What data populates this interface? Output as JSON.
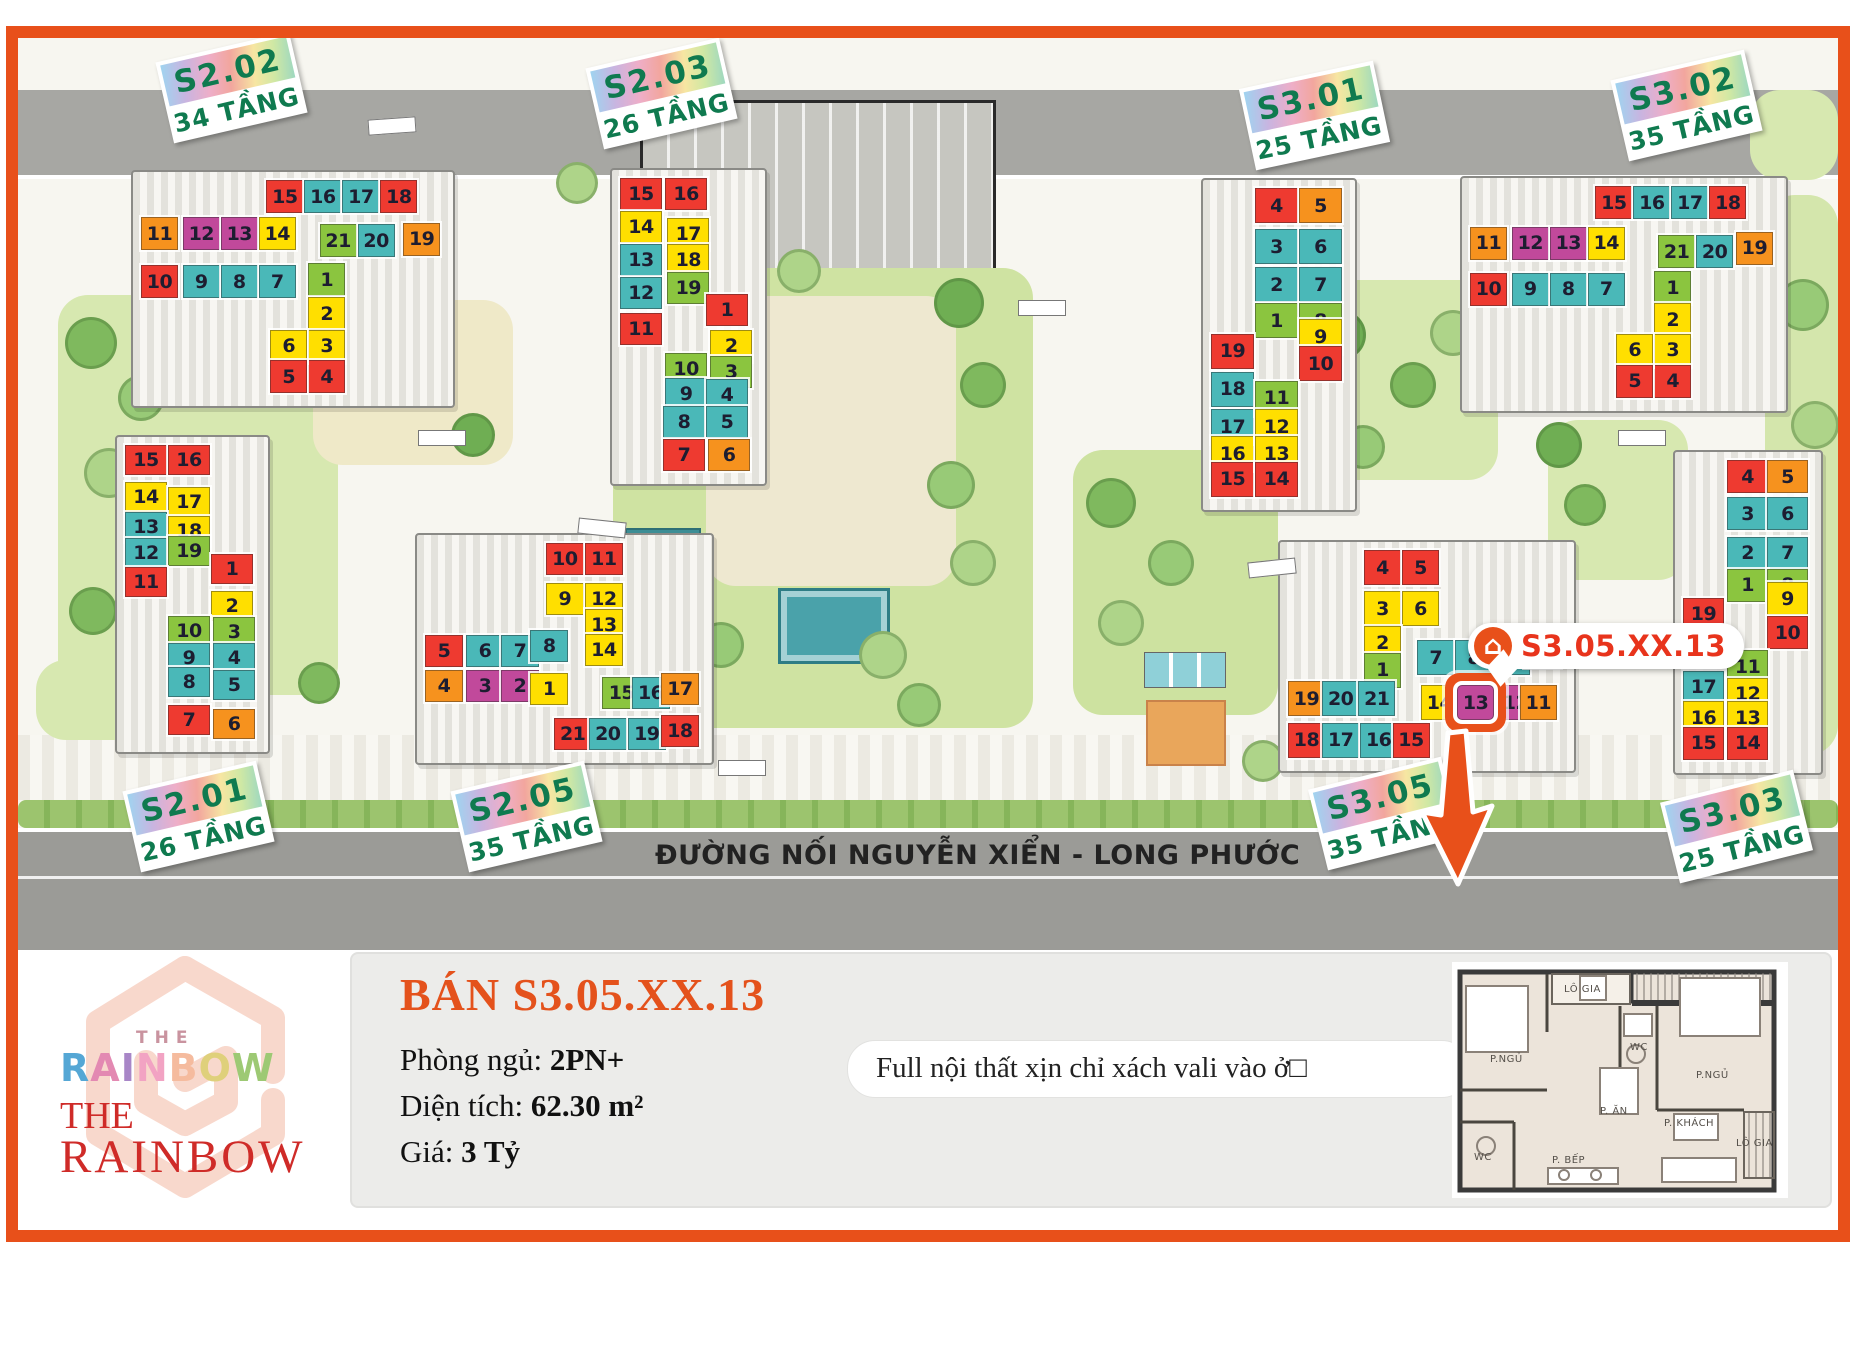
{
  "map": {
    "road_label": "ĐƯỜNG NỐI NGUYỄN XIỂN - LONG PHƯỚC",
    "callout": {
      "label": "S3.05.XX.13",
      "icon": "home"
    },
    "palette": {
      "R": "#ee3a30",
      "T": "#4ab8b8",
      "Y": "#ffdf00",
      "O": "#f6921e",
      "P": "#c1499b",
      "G": "#8bc53f"
    },
    "buildings": [
      {
        "name": "S2.02",
        "floors": "34 TẦNG",
        "badge": [
          145,
          8,
          -13
        ],
        "origin": [
          123,
          142
        ],
        "cell": [
          38,
          34
        ],
        "units": [
          [
            15,
            "R",
            3.3,
            0
          ],
          [
            16,
            "T",
            4.3,
            0
          ],
          [
            17,
            "T",
            5.3,
            0
          ],
          [
            18,
            "R",
            6.3,
            0
          ],
          [
            11,
            "O",
            0,
            1.1
          ],
          [
            12,
            "P",
            1.1,
            1.1
          ],
          [
            13,
            "P",
            2.1,
            1.1
          ],
          [
            14,
            "Y",
            3.1,
            1.1
          ],
          [
            21,
            "G",
            4.7,
            1.3
          ],
          [
            20,
            "T",
            5.7,
            1.3
          ],
          [
            19,
            "O",
            6.9,
            1.25
          ],
          [
            10,
            "R",
            0,
            2.5
          ],
          [
            9,
            "T",
            1.1,
            2.5
          ],
          [
            8,
            "T",
            2.1,
            2.5
          ],
          [
            7,
            "T",
            3.1,
            2.5
          ],
          [
            1,
            "G",
            4.4,
            2.45
          ],
          [
            2,
            "Y",
            4.4,
            3.45
          ],
          [
            3,
            "Y",
            4.4,
            4.4
          ],
          [
            4,
            "R",
            4.4,
            5.3
          ],
          [
            6,
            "Y",
            3.4,
            4.4
          ],
          [
            5,
            "R",
            3.4,
            5.3
          ]
        ]
      },
      {
        "name": "S2.03",
        "floors": "26 TẦNG",
        "badge": [
          575,
          14,
          -13
        ],
        "origin": [
          602,
          140
        ],
        "cell": [
          43,
          33
        ],
        "units": [
          [
            15,
            "R",
            0,
            0
          ],
          [
            16,
            "R",
            1.05,
            0
          ],
          [
            14,
            "Y",
            0,
            1
          ],
          [
            17,
            "Y",
            1.1,
            1.2
          ],
          [
            13,
            "T",
            0,
            2
          ],
          [
            18,
            "Y",
            1.1,
            2.0
          ],
          [
            12,
            "T",
            0,
            3
          ],
          [
            19,
            "G",
            1.1,
            2.85
          ],
          [
            11,
            "R",
            0,
            4.1
          ],
          [
            1,
            "R",
            2.0,
            3.5
          ],
          [
            2,
            "Y",
            2.1,
            4.6
          ],
          [
            10,
            "G",
            1.05,
            5.3
          ],
          [
            3,
            "G",
            2.1,
            5.4
          ],
          [
            9,
            "T",
            1.05,
            6.05
          ],
          [
            4,
            "T",
            2.0,
            6.1
          ],
          [
            8,
            "T",
            1.0,
            6.9
          ],
          [
            5,
            "T",
            2.0,
            6.9
          ],
          [
            7,
            "R",
            1.0,
            7.9
          ],
          [
            6,
            "O",
            2.05,
            7.9
          ]
        ]
      },
      {
        "name": "S3.01",
        "floors": "25 TẦNG",
        "badge": [
          1228,
          36,
          -12
        ],
        "origin": [
          1193,
          150
        ],
        "cell": [
          44,
          36
        ],
        "units": [
          [
            4,
            "R",
            1,
            0
          ],
          [
            5,
            "O",
            2,
            0
          ],
          [
            3,
            "T",
            1,
            1.15
          ],
          [
            6,
            "T",
            2,
            1.15
          ],
          [
            2,
            "T",
            1,
            2.2
          ],
          [
            7,
            "T",
            2,
            2.2
          ],
          [
            1,
            "G",
            1,
            3.2
          ],
          [
            8,
            "G",
            2,
            3.2
          ],
          [
            9,
            "Y",
            2,
            3.65
          ],
          [
            10,
            "R",
            2,
            4.4
          ],
          [
            19,
            "R",
            0,
            4.05
          ],
          [
            18,
            "T",
            0,
            5.1
          ],
          [
            17,
            "T",
            0,
            6.15
          ],
          [
            16,
            "Y",
            0,
            6.9
          ],
          [
            15,
            "R",
            0,
            7.6
          ],
          [
            11,
            "G",
            1,
            5.35
          ],
          [
            12,
            "Y",
            1,
            6.15
          ],
          [
            13,
            "Y",
            1,
            6.9
          ],
          [
            14,
            "R",
            1,
            7.6
          ]
        ]
      },
      {
        "name": "S3.02",
        "floors": "35 TẦNG",
        "badge": [
          1600,
          26,
          -13
        ],
        "origin": [
          1452,
          148
        ],
        "cell": [
          38,
          34
        ],
        "units": [
          [
            15,
            "R",
            3.3,
            0
          ],
          [
            16,
            "T",
            4.3,
            0
          ],
          [
            17,
            "T",
            5.3,
            0
          ],
          [
            18,
            "R",
            6.3,
            0
          ],
          [
            11,
            "O",
            0,
            1.2
          ],
          [
            12,
            "P",
            1.1,
            1.2
          ],
          [
            13,
            "P",
            2.1,
            1.2
          ],
          [
            14,
            "Y",
            3.1,
            1.2
          ],
          [
            21,
            "G",
            4.95,
            1.45
          ],
          [
            20,
            "T",
            5.95,
            1.45
          ],
          [
            19,
            "O",
            7.0,
            1.35
          ],
          [
            10,
            "R",
            0,
            2.55
          ],
          [
            9,
            "T",
            1.1,
            2.55
          ],
          [
            8,
            "T",
            2.1,
            2.55
          ],
          [
            7,
            "T",
            3.1,
            2.55
          ],
          [
            1,
            "G",
            4.85,
            2.5
          ],
          [
            2,
            "Y",
            4.85,
            3.45
          ],
          [
            3,
            "Y",
            4.85,
            4.35
          ],
          [
            4,
            "R",
            4.85,
            5.25
          ],
          [
            6,
            "Y",
            3.85,
            4.35
          ],
          [
            5,
            "R",
            3.85,
            5.25
          ]
        ]
      },
      {
        "name": "S2.01",
        "floors": "26 TẦNG",
        "badge": [
          112,
          737,
          -13
        ],
        "origin": [
          107,
          407
        ],
        "cell": [
          43,
          31
        ],
        "units": [
          [
            15,
            "R",
            0,
            0
          ],
          [
            16,
            "R",
            1.0,
            0
          ],
          [
            14,
            "Y",
            0,
            1.2
          ],
          [
            17,
            "Y",
            1.0,
            1.35
          ],
          [
            13,
            "T",
            0,
            2.15
          ],
          [
            18,
            "Y",
            1.0,
            2.3
          ],
          [
            12,
            "T",
            0,
            3.0
          ],
          [
            19,
            "G",
            1.0,
            2.95
          ],
          [
            11,
            "R",
            0,
            3.95
          ],
          [
            1,
            "R",
            2.0,
            3.5
          ],
          [
            2,
            "Y",
            2.0,
            4.7
          ],
          [
            10,
            "G",
            1.0,
            5.5
          ],
          [
            3,
            "G",
            2.05,
            5.55
          ],
          [
            9,
            "T",
            1.0,
            6.4
          ],
          [
            4,
            "T",
            2.05,
            6.4
          ],
          [
            8,
            "T",
            1.0,
            7.15
          ],
          [
            5,
            "T",
            2.05,
            7.25
          ],
          [
            7,
            "R",
            1.0,
            8.4
          ],
          [
            6,
            "O",
            2.05,
            8.5
          ]
        ]
      },
      {
        "name": "S2.05",
        "floors": "35 TẦNG",
        "badge": [
          440,
          737,
          -13
        ],
        "origin": [
          407,
          505
        ],
        "cell": [
          39,
          33
        ],
        "units": [
          [
            10,
            "R",
            3.1,
            0
          ],
          [
            11,
            "R",
            4.1,
            0
          ],
          [
            9,
            "Y",
            3.1,
            1.2
          ],
          [
            12,
            "Y",
            4.1,
            1.2
          ],
          [
            13,
            "Y",
            4.1,
            2.0
          ],
          [
            14,
            "Y",
            4.1,
            2.75
          ],
          [
            5,
            "R",
            0,
            2.8
          ],
          [
            6,
            "T",
            1.05,
            2.8
          ],
          [
            7,
            "T",
            1.95,
            2.8
          ],
          [
            8,
            "T",
            2.7,
            2.65
          ],
          [
            4,
            "O",
            0,
            3.85
          ],
          [
            3,
            "P",
            1.05,
            3.85
          ],
          [
            2,
            "P",
            1.95,
            3.85
          ],
          [
            1,
            "Y",
            2.7,
            3.95
          ],
          [
            15,
            "G",
            4.55,
            4.05
          ],
          [
            16,
            "T",
            5.3,
            4.05
          ],
          [
            17,
            "O",
            6.05,
            3.95
          ],
          [
            21,
            "R",
            3.3,
            5.3
          ],
          [
            20,
            "T",
            4.2,
            5.3
          ],
          [
            19,
            "T",
            5.2,
            5.3
          ],
          [
            18,
            "R",
            6.05,
            5.2
          ]
        ]
      },
      {
        "name": "S3.05",
        "floors": "35 TẦNG",
        "badge": [
          1298,
          734,
          -14
        ],
        "origin": [
          1270,
          512
        ],
        "cell": [
          38,
          36
        ],
        "units": [
          [
            4,
            "R",
            2.0,
            0
          ],
          [
            5,
            "R",
            3.0,
            0
          ],
          [
            3,
            "Y",
            2.0,
            1.15
          ],
          [
            6,
            "Y",
            3.0,
            1.15
          ],
          [
            2,
            "Y",
            2.0,
            2.1
          ],
          [
            1,
            "G",
            2.0,
            2.85
          ],
          [
            7,
            "T",
            3.4,
            2.5
          ],
          [
            8,
            "T",
            4.4,
            2.5
          ],
          [
            9,
            "T",
            5.4,
            2.5
          ],
          [
            10,
            "R",
            6.2,
            2.3
          ],
          [
            19,
            "O",
            0,
            3.65
          ],
          [
            20,
            "T",
            0.9,
            3.65
          ],
          [
            21,
            "T",
            1.85,
            3.65
          ],
          [
            14,
            "Y",
            3.5,
            3.75
          ],
          [
            13,
            "P",
            4.45,
            3.75,
            1
          ],
          [
            12,
            "P",
            5.5,
            3.75
          ],
          [
            11,
            "O",
            6.1,
            3.75
          ],
          [
            18,
            "R",
            0,
            4.8
          ],
          [
            17,
            "T",
            0.9,
            4.8
          ],
          [
            16,
            "T",
            1.9,
            4.8
          ],
          [
            15,
            "R",
            2.75,
            4.8
          ]
        ]
      },
      {
        "name": "S3.03",
        "floors": "25 TẦNG",
        "badge": [
          1650,
          747,
          -14
        ],
        "origin": [
          1665,
          422
        ],
        "cell": [
          42,
          34
        ],
        "units": [
          [
            4,
            "R",
            1.05,
            0
          ],
          [
            5,
            "O",
            2.0,
            0
          ],
          [
            3,
            "T",
            1.05,
            1.1
          ],
          [
            6,
            "T",
            2.0,
            1.1
          ],
          [
            2,
            "T",
            1.05,
            2.25
          ],
          [
            7,
            "T",
            2.0,
            2.25
          ],
          [
            1,
            "G",
            1.05,
            3.2
          ],
          [
            8,
            "G",
            2.0,
            3.2
          ],
          [
            9,
            "Y",
            2.0,
            3.6
          ],
          [
            10,
            "R",
            2.0,
            4.6
          ],
          [
            19,
            "R",
            0,
            4.05
          ],
          [
            18,
            "T",
            0,
            5.1
          ],
          [
            17,
            "T",
            0,
            6.2
          ],
          [
            16,
            "Y",
            0,
            7.1
          ],
          [
            15,
            "R",
            0,
            7.85
          ],
          [
            11,
            "G",
            1.05,
            5.6
          ],
          [
            12,
            "Y",
            1.05,
            6.4
          ],
          [
            13,
            "Y",
            1.05,
            7.1
          ],
          [
            14,
            "R",
            1.05,
            7.85
          ]
        ]
      }
    ]
  },
  "panel": {
    "title": "BÁN S3.05.XX.13",
    "fields": [
      {
        "label": "Phòng ngủ: ",
        "value": "2PN+"
      },
      {
        "label": "Diện tích: ",
        "value": "62.30 m²"
      },
      {
        "label": "Giá: ",
        "value": "3 Tỷ"
      }
    ],
    "note": "Full nội thất xịn chỉ xách vali vào ở□"
  },
  "logo": {
    "the_small": "THE",
    "rainbow_letters": [
      [
        "R",
        "#55a7d5"
      ],
      [
        "A",
        "#e389b2"
      ],
      [
        "I",
        "#a886c7"
      ],
      [
        "N",
        "#f2a3c3"
      ],
      [
        "B",
        "#f5bb9e"
      ],
      [
        "O",
        "#dfd07b"
      ],
      [
        "W",
        "#9dc974"
      ]
    ],
    "the_red": "THE",
    "rainbow_red": "RAINBOW"
  },
  "floorplan": {
    "labels": [
      {
        "t": "LÔ GIA",
        "x": 112,
        "y": 30
      },
      {
        "t": "WC",
        "x": 178,
        "y": 88
      },
      {
        "t": "P.NGỦ",
        "x": 38,
        "y": 100
      },
      {
        "t": "P.NGỦ",
        "x": 244,
        "y": 116
      },
      {
        "t": "P. ĂN",
        "x": 148,
        "y": 152
      },
      {
        "t": "P. KHÁCH",
        "x": 212,
        "y": 164
      },
      {
        "t": "LÔ GIA",
        "x": 286,
        "y": 184
      },
      {
        "t": "WC",
        "x": 22,
        "y": 198
      },
      {
        "t": "P. BẾP",
        "x": 100,
        "y": 201
      }
    ]
  }
}
